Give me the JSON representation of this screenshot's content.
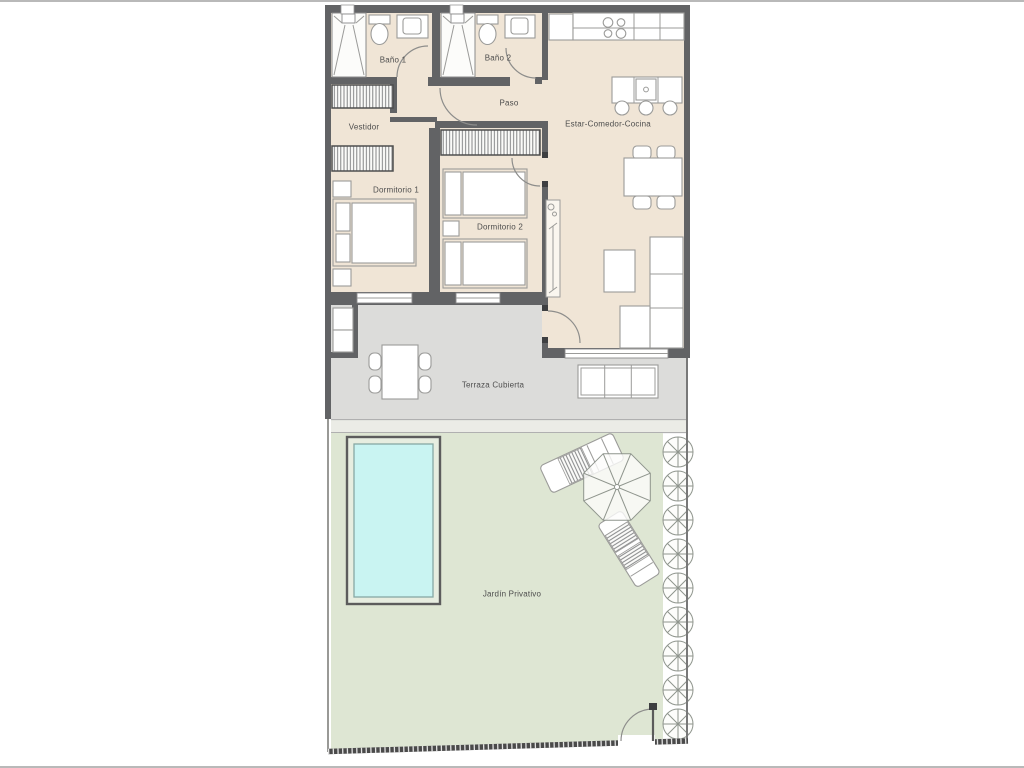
{
  "floorplan": {
    "title": "Apartment floor plan with private garden and pool",
    "labels": {
      "bano1": "Baño 1",
      "bano2": "Baño 2",
      "paso": "Paso",
      "vestidor": "Vestidor",
      "dormitorio1": "Dormitorio 1",
      "dormitorio2": "Dormitorio 2",
      "estar": "Estar-Comedor-Cocina",
      "terraza": "Terraza Cubierta",
      "jardin": "Jardín Privativo"
    },
    "colors": {
      "floor": "#f0e5d6",
      "terrace": "#dcdcda",
      "garden": "#dee6d3",
      "pool_frame": "#e7ede0",
      "water": "#c9f4f2",
      "wall": "#626365",
      "page_border": "#b9b9b9"
    }
  }
}
